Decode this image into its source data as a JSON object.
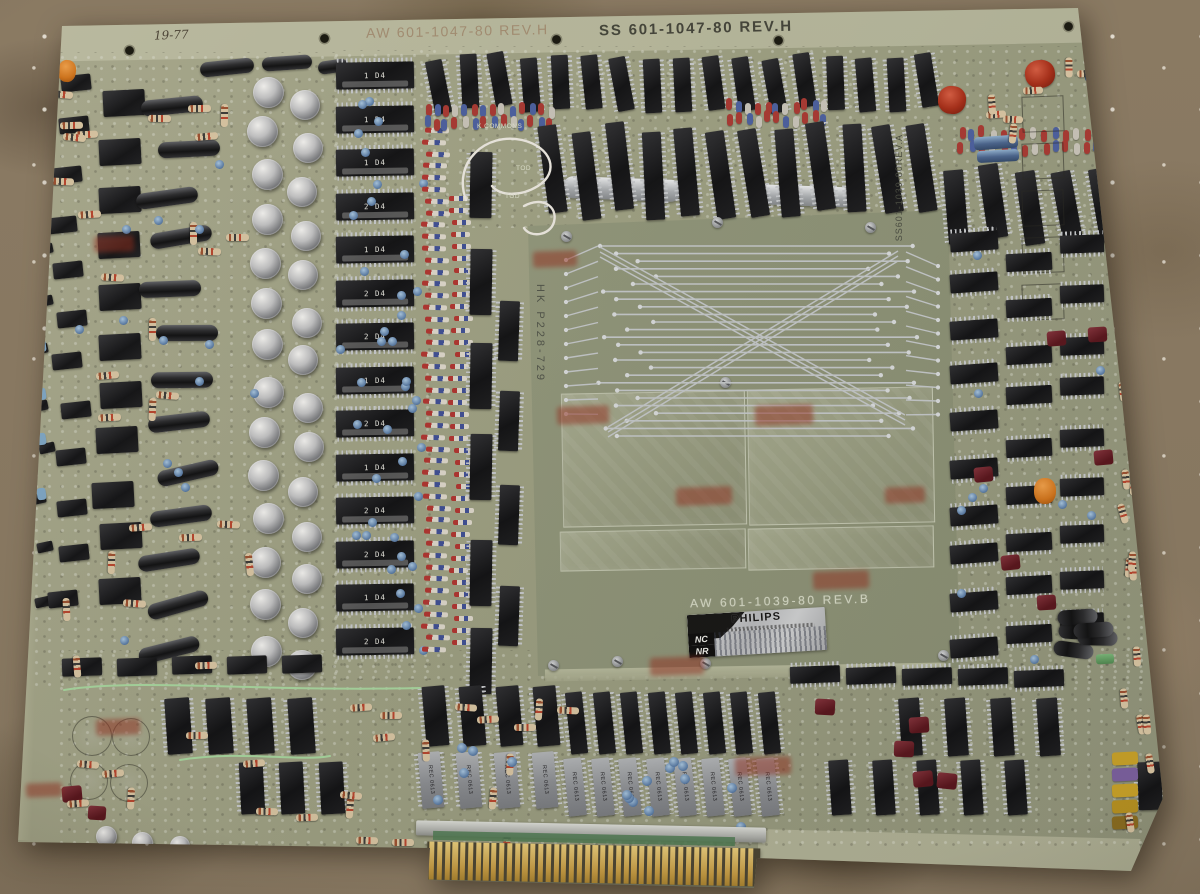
{
  "scene": {
    "description": "Photograph of a large vintage Philips circuit board (organ key-contact board) lying on brown carpet",
    "colors": {
      "carpet": "#8b7b64",
      "board": "#9da083",
      "shield_panel": "#8f957a",
      "gold_fingers": "#c49a42",
      "stamp_red": "#942c1c",
      "sticker_silver": "#c6c8ca"
    }
  },
  "markings": {
    "top_left": "AW 601-1047-80 REV.H",
    "top_right": "SS 601-1047-80 REV.H",
    "handwritten_date": "19-77",
    "left_edge_note": "F-08 = 1,001",
    "panel_vertical": "HK P228-729",
    "panel_label": "AW 601-1039-80 REV.B",
    "right_vertical": "SS601-1039-80REV.A",
    "silkscreen_k_commons": "K COMMONS",
    "silkscreen_tod": "TOD",
    "bottom_chip_text": "REC 0613"
  },
  "sticker": {
    "brand": "PHILIPS",
    "row1_label": "NC",
    "row2_label": "NR"
  },
  "mid_ic_labels": [
    "1 D4",
    "1 D4",
    "1 D4",
    "2 D4",
    "1 D4",
    "2 D4",
    "2 D4",
    "1 D4",
    "2 D4",
    "1 D4",
    "2 D4",
    "2 D4",
    "1 D4",
    "2 D4"
  ],
  "counts": {
    "edge_connector_fingers": 42,
    "fan_lines": 26,
    "fan_side_lines": 12,
    "diagonal_band_lines": 3
  },
  "holes": [
    [
      123,
      44
    ],
    [
      318,
      32
    ],
    [
      550,
      33
    ],
    [
      772,
      34
    ],
    [
      1062,
      20
    ]
  ],
  "screws": [
    [
      561,
      231
    ],
    [
      712,
      217
    ],
    [
      865,
      222
    ],
    [
      720,
      377
    ],
    [
      548,
      660
    ],
    [
      612,
      656
    ],
    [
      700,
      658
    ],
    [
      938,
      650
    ]
  ],
  "stamps": [
    [
      94,
      236,
      40,
      16
    ],
    [
      533,
      251,
      44,
      16
    ],
    [
      557,
      406,
      52,
      18
    ],
    [
      755,
      405,
      58,
      20
    ],
    [
      676,
      487,
      56,
      18
    ],
    [
      885,
      487,
      40,
      16
    ],
    [
      813,
      571,
      56,
      18
    ],
    [
      650,
      657,
      54,
      18
    ],
    [
      735,
      757,
      56,
      18
    ],
    [
      96,
      719,
      44,
      16
    ],
    [
      26,
      783,
      36,
      14
    ]
  ],
  "zones": [
    {
      "name": "left-mini-column",
      "type": "relay",
      "x": 34,
      "y": 96,
      "rows": 11,
      "cols": 1,
      "dy": 50,
      "w": 16,
      "h": 10,
      "angle": -12,
      "jx": 6,
      "jy": 5
    },
    {
      "name": "left-relay-col-inner",
      "type": "relay",
      "x": 54,
      "y": 74,
      "rows": 12,
      "cols": 1,
      "dy": 47,
      "w": 30,
      "h": 16,
      "angle": -6,
      "jx": 8,
      "jy": 4
    },
    {
      "name": "left-relay-col-main",
      "type": "relay",
      "x": 98,
      "y": 86,
      "rows": 11,
      "cols": 1,
      "dy": 49,
      "w": 42,
      "h": 26,
      "angle": -3,
      "jx": 6,
      "jy": 4
    },
    {
      "name": "left-axial-caps",
      "type": "axcap",
      "x": 148,
      "y": 94,
      "rows": 13,
      "cols": 1,
      "dy": 46,
      "w": 62,
      "h": 16,
      "angle": -8,
      "jx": 16,
      "jy": 4,
      "ja": 8
    },
    {
      "name": "tl-axcaps",
      "type": "axcap",
      "items": [
        [
          200,
          60,
          54,
          15,
          -6
        ],
        [
          262,
          56,
          50,
          14,
          -4
        ],
        [
          318,
          60,
          30,
          13,
          -8
        ]
      ]
    },
    {
      "name": "left-can-col-a",
      "type": "can",
      "x": 250,
      "y": 74,
      "rows": 14,
      "cols": 1,
      "dy": 43,
      "w": 31,
      "h": 31,
      "jx": 4,
      "jy": 3
    },
    {
      "name": "left-can-col-b",
      "type": "can",
      "x": 290,
      "y": 90,
      "rows": 14,
      "cols": 1,
      "dy": 43,
      "w": 30,
      "h": 30,
      "jx": 4,
      "jy": 3
    },
    {
      "name": "left-resistors",
      "type": "resistor",
      "scatter": true,
      "count": 26,
      "x": 44,
      "y": 72,
      "aw": 200,
      "ah": 580,
      "w": 23,
      "h": 7,
      "mix": true
    },
    {
      "name": "left-blue-discs",
      "type": "disc",
      "scatter": true,
      "count": 14,
      "x": 60,
      "y": 90,
      "aw": 190,
      "ah": 560,
      "w": 9,
      "h": 9
    },
    {
      "name": "left-blue-beads",
      "type": "bead",
      "x": 37,
      "y": 150,
      "rows": 8,
      "cols": 1,
      "dy": 48,
      "w": 9,
      "h": 12,
      "colors": [
        "#7fa8c8"
      ],
      "angle": -8,
      "jy": 6
    },
    {
      "name": "mid-ic-column",
      "type": "icl",
      "x": 336,
      "y": 62,
      "rows": 14,
      "cols": 1,
      "dy": 43.5,
      "w": 78,
      "h": 27,
      "angle": -1,
      "labeled": true
    },
    {
      "name": "mid-discs",
      "type": "disc",
      "scatter": true,
      "count": 40,
      "x": 332,
      "y": 92,
      "aw": 88,
      "ah": 576,
      "w": 9,
      "h": 9
    },
    {
      "name": "diode-strip-outer",
      "type": "diode",
      "x": 424,
      "y": 128,
      "rows": 45,
      "cols": 1,
      "dy": 11.8,
      "w": 24,
      "h": 5,
      "angle": 2,
      "jx": 3
    },
    {
      "name": "diode-strip-inner",
      "type": "diode",
      "x": 452,
      "y": 196,
      "rows": 38,
      "cols": 1,
      "dy": 12,
      "w": 19,
      "h": 5,
      "jx": 4
    },
    {
      "name": "inner-vert-ics-a",
      "type": "ic",
      "vert": true,
      "x": 470,
      "y": 150,
      "rows": 6,
      "cols": 1,
      "dy": 96,
      "w": 22,
      "h": 66,
      "angle": 1,
      "jy": 6
    },
    {
      "name": "inner-vert-ics-b",
      "type": "ic",
      "vert": true,
      "x": 499,
      "y": 300,
      "rows": 4,
      "cols": 1,
      "dy": 95,
      "w": 20,
      "h": 60,
      "angle": 2,
      "jy": 6
    },
    {
      "name": "top-ic-row-1",
      "type": "ic",
      "vert": true,
      "x": 430,
      "y": 56,
      "cols": 17,
      "rows": 1,
      "dx": 30.5,
      "w": 17,
      "h": 54,
      "angle": -7,
      "ja": 5,
      "jy": 4
    },
    {
      "name": "top-diode-band-left",
      "type": "bead",
      "x": 424,
      "y": 104,
      "cols": 14,
      "rows": 2,
      "dx": 9.5,
      "dy": 13,
      "w": 6,
      "h": 12,
      "colors": [
        "#a83832",
        "#4a5fa0",
        "#a83832",
        "#c8c4ba",
        "#4a5fa0"
      ],
      "jx": 2,
      "jy": 3
    },
    {
      "name": "top-diode-band-mid",
      "type": "bead",
      "x": 726,
      "y": 100,
      "cols": 11,
      "rows": 2,
      "dx": 9.5,
      "dy": 13,
      "w": 6,
      "h": 12,
      "colors": [
        "#a83832",
        "#4a5fa0",
        "#c8c4ba",
        "#a83832"
      ],
      "jx": 2,
      "jy": 3
    },
    {
      "name": "top-diode-band-right",
      "type": "bead",
      "x": 958,
      "y": 128,
      "cols": 16,
      "rows": 2,
      "dx": 10.5,
      "dy": 14,
      "w": 6,
      "h": 12,
      "colors": [
        "#a83832",
        "#4a5fa0",
        "#a83832",
        "#c8c4ba"
      ],
      "jx": 2,
      "jy": 3
    },
    {
      "name": "crystal-cans",
      "type": "crystal",
      "items": [
        [
          563,
          178,
          118,
          22,
          2
        ],
        [
          757,
          186,
          104,
          20,
          2
        ]
      ]
    },
    {
      "name": "top-ic-row-2",
      "type": "ic",
      "vert": true,
      "x": 543,
      "y": 128,
      "cols": 12,
      "rows": 1,
      "dx": 33.5,
      "w": 19,
      "h": 88,
      "angle": -6,
      "ja": 4,
      "jy": 6
    },
    {
      "name": "top-right-ics",
      "type": "ic",
      "vert": true,
      "x": 946,
      "y": 168,
      "cols": 5,
      "rows": 1,
      "dx": 37,
      "w": 20,
      "h": 74,
      "angle": -8,
      "ja": 4,
      "jy": 5
    },
    {
      "name": "tr-red-tantalums",
      "type": "tant",
      "items": [
        [
          1025,
          60,
          30,
          28,
          -8
        ],
        [
          938,
          86,
          28,
          28,
          6
        ]
      ]
    },
    {
      "name": "tr-blue-cyls",
      "type": "bluecap",
      "items": [
        [
          974,
          136,
          44,
          13,
          -4
        ],
        [
          977,
          150,
          42,
          12,
          -3
        ],
        [
          1088,
          40,
          26,
          44,
          10
        ]
      ]
    },
    {
      "name": "tr-outlines",
      "type": "outline",
      "x": 1022,
      "y": 96,
      "rows": 5,
      "cols": 1,
      "dy": 47,
      "w": 40,
      "h": 34,
      "angle": -2
    },
    {
      "name": "tr-resistors",
      "type": "resistor",
      "scatter": true,
      "count": 9,
      "x": 950,
      "y": 58,
      "aw": 170,
      "ah": 80,
      "w": 20,
      "h": 7,
      "mix": true
    },
    {
      "name": "right-ladder-a",
      "type": "ic",
      "x": 950,
      "y": 232,
      "rows": 10,
      "cols": 1,
      "dy": 45,
      "w": 48,
      "h": 19,
      "angle": -4,
      "jy": 5
    },
    {
      "name": "right-ladder-b",
      "type": "ic",
      "x": 1006,
      "y": 252,
      "rows": 9,
      "cols": 1,
      "dy": 46,
      "w": 46,
      "h": 18,
      "angle": -3,
      "jy": 5
    },
    {
      "name": "right-ladder-c",
      "type": "ic",
      "x": 1060,
      "y": 240,
      "rows": 9,
      "cols": 1,
      "dy": 47,
      "w": 44,
      "h": 18,
      "angle": -2,
      "jy": 5
    },
    {
      "name": "right-edge-resistors",
      "type": "resistor",
      "scatter": true,
      "count": 14,
      "x": 1104,
      "y": 250,
      "aw": 56,
      "ah": 430,
      "w": 20,
      "h": 7,
      "angle": 85,
      "ja": 12
    },
    {
      "name": "right-maroon-caps",
      "type": "maroon",
      "scatter": true,
      "count": 6,
      "x": 955,
      "y": 300,
      "aw": 140,
      "ah": 340,
      "w": 19,
      "h": 15
    },
    {
      "name": "right-orange-cap",
      "type": "orange",
      "items": [
        [
          1034,
          478,
          22,
          26,
          0
        ]
      ]
    },
    {
      "name": "right-discs",
      "type": "disc",
      "scatter": true,
      "count": 10,
      "x": 950,
      "y": 240,
      "aw": 150,
      "ah": 420,
      "w": 9,
      "h": 9
    },
    {
      "name": "right-black-caps",
      "type": "axcap",
      "scatter": true,
      "count": 5,
      "x": 1055,
      "y": 555,
      "aw": 55,
      "ah": 105,
      "w": 15,
      "h": 40,
      "angle": 88,
      "ja": 10
    },
    {
      "name": "bottom-left-band",
      "type": "relay",
      "x": 62,
      "y": 658,
      "cols": 5,
      "rows": 1,
      "dx": 55,
      "w": 40,
      "h": 18,
      "angle": -2,
      "jy": 4
    },
    {
      "name": "bottom-left-ics-a",
      "type": "ic",
      "vert": true,
      "x": 166,
      "y": 698,
      "cols": 4,
      "rows": 1,
      "dx": 41,
      "w": 25,
      "h": 56,
      "angle": -4
    },
    {
      "name": "bottom-left-ics-b",
      "type": "ic",
      "vert": true,
      "x": 240,
      "y": 762,
      "cols": 3,
      "rows": 1,
      "dx": 40,
      "w": 24,
      "h": 52,
      "angle": -3
    },
    {
      "name": "bottom-black-ics-l",
      "type": "ic",
      "vert": true,
      "x": 424,
      "y": 686,
      "cols": 4,
      "rows": 1,
      "dx": 37,
      "w": 23,
      "h": 60,
      "angle": -5
    },
    {
      "name": "bottom-ceramic-l",
      "type": "ceramic",
      "vert": true,
      "x": 420,
      "y": 752,
      "cols": 4,
      "rows": 1,
      "dx": 38,
      "w": 22,
      "h": 56,
      "angle": -5,
      "labeled": "chip"
    },
    {
      "name": "bottom-black-row",
      "type": "ic",
      "vert": true,
      "x": 568,
      "y": 692,
      "cols": 8,
      "rows": 1,
      "dx": 27.5,
      "w": 17,
      "h": 62,
      "angle": -6
    },
    {
      "name": "bottom-ceramic-row",
      "type": "ceramic",
      "vert": true,
      "x": 566,
      "y": 758,
      "cols": 8,
      "rows": 1,
      "dx": 27.5,
      "w": 18,
      "h": 58,
      "angle": -6,
      "labeled": "chip"
    },
    {
      "name": "bottom-mid-resistors",
      "type": "resistor",
      "scatter": true,
      "count": 16,
      "x": 330,
      "y": 700,
      "aw": 230,
      "ah": 140,
      "w": 22,
      "h": 7,
      "mix": true
    },
    {
      "name": "bottom-discs",
      "type": "disc",
      "scatter": true,
      "count": 16,
      "x": 420,
      "y": 740,
      "aw": 370,
      "ah": 90,
      "w": 10,
      "h": 10
    },
    {
      "name": "bottom-right-ics-a",
      "type": "ic",
      "x": 790,
      "y": 668,
      "cols": 5,
      "rows": 1,
      "dx": 56,
      "w": 50,
      "h": 17,
      "angle": -2,
      "jy": 3
    },
    {
      "name": "bottom-right-ics-b",
      "type": "ic",
      "vert": true,
      "x": 900,
      "y": 698,
      "cols": 4,
      "rows": 1,
      "dx": 46,
      "w": 21,
      "h": 58,
      "angle": -4
    },
    {
      "name": "bottom-right-ics-c",
      "type": "ic",
      "vert": true,
      "x": 830,
      "y": 760,
      "cols": 5,
      "rows": 1,
      "dx": 44,
      "w": 20,
      "h": 55,
      "angle": -4
    },
    {
      "name": "bottom-right-edge-ic",
      "type": "ic",
      "vert": true,
      "x": 1138,
      "y": 762,
      "cols": 1,
      "rows": 1,
      "w": 24,
      "h": 48,
      "angle": -2
    },
    {
      "name": "bead-stack",
      "type": "bead",
      "x": 1112,
      "y": 752,
      "rows": 5,
      "cols": 1,
      "dy": 16,
      "w": 26,
      "h": 13,
      "colors": [
        "#c9a227",
        "#7a5fa0",
        "#c9a227",
        "#b8921f",
        "#8a6c1f"
      ],
      "angle": -3
    },
    {
      "name": "green-cap",
      "type": "green",
      "items": [
        [
          1096,
          654,
          18,
          10,
          -3
        ]
      ]
    },
    {
      "name": "bottom-maroon",
      "type": "maroon",
      "scatter": true,
      "count": 5,
      "x": 800,
      "y": 690,
      "aw": 260,
      "ah": 140,
      "w": 20,
      "h": 16
    },
    {
      "name": "bottom-left-circles",
      "type": "circle-outline",
      "items": [
        [
          72,
          716,
          38,
          38,
          0
        ],
        [
          112,
          718,
          36,
          36,
          0
        ],
        [
          70,
          762,
          36,
          36,
          0
        ],
        [
          110,
          764,
          36,
          36,
          0
        ]
      ]
    },
    {
      "name": "bottom-small-cans",
      "type": "can",
      "items": [
        [
          96,
          826,
          21,
          21,
          0
        ],
        [
          132,
          832,
          21,
          21,
          0
        ],
        [
          170,
          836,
          20,
          20,
          0
        ]
      ]
    },
    {
      "name": "bl-maroon",
      "type": "maroon",
      "items": [
        [
          62,
          786,
          20,
          16,
          -5
        ],
        [
          88,
          806,
          18,
          14,
          4
        ]
      ]
    },
    {
      "name": "bottom-left-resistors",
      "type": "resistor",
      "scatter": true,
      "count": 10,
      "x": 60,
      "y": 660,
      "aw": 270,
      "ah": 170,
      "w": 22,
      "h": 7,
      "mix": true
    },
    {
      "name": "br-edge-resistors",
      "type": "resistor",
      "scatter": true,
      "count": 8,
      "x": 1110,
      "y": 680,
      "aw": 50,
      "ah": 150,
      "w": 20,
      "h": 7,
      "angle": 85,
      "ja": 10
    },
    {
      "name": "tl-orange",
      "type": "orange",
      "items": [
        [
          58,
          60,
          18,
          22,
          6
        ]
      ]
    }
  ]
}
